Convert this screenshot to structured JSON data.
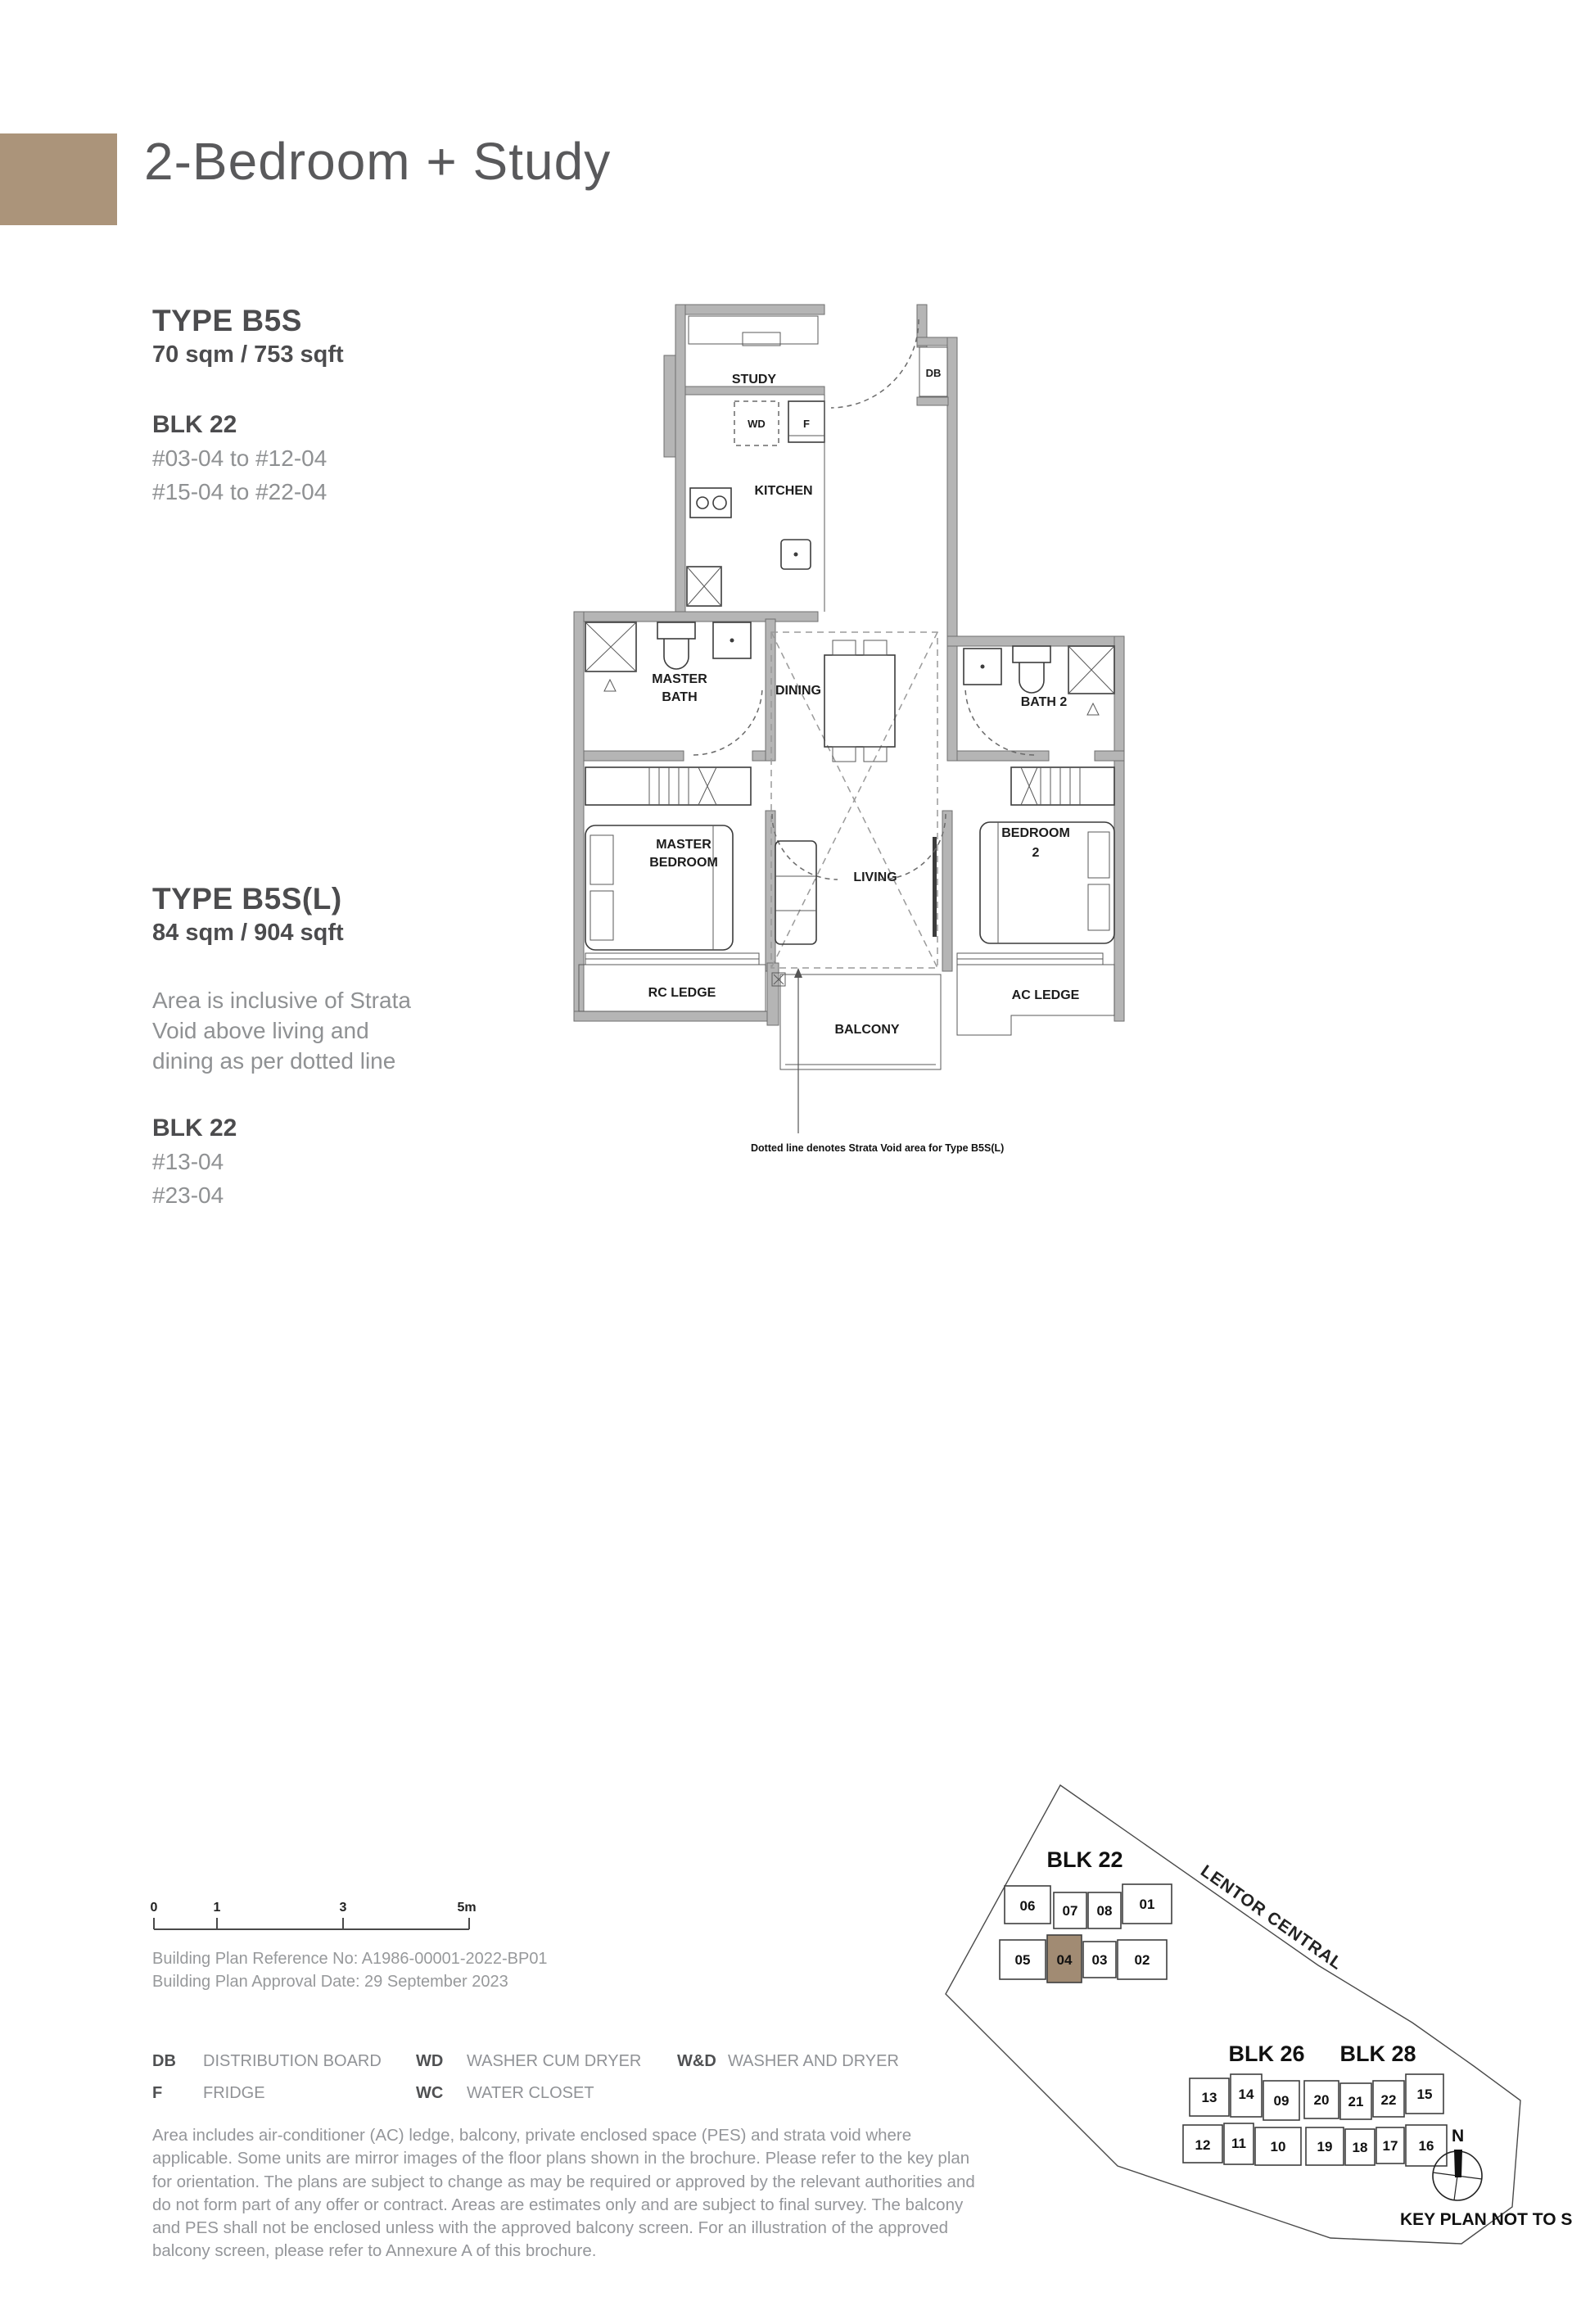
{
  "header": {
    "title": "2-Bedroom + Study",
    "accent_color": "#ab947a"
  },
  "unit_info": {
    "b5s": {
      "type": "TYPE B5S",
      "area": "70 sqm / 753 sqft",
      "block": "BLK 22",
      "floors": [
        "#03-04 to #12-04",
        "#15-04 to #22-04"
      ]
    },
    "b5sl": {
      "type": "TYPE B5S(L)",
      "area": "84 sqm / 904 sqft",
      "note": "Area is inclusive of Strata Void above living and dining as per dotted line",
      "block": "BLK 22",
      "floors": [
        "#13-04",
        "#23-04"
      ]
    }
  },
  "floor_plan": {
    "rooms": {
      "study": "STUDY",
      "kitchen": "KITCHEN",
      "dining": "DINING",
      "master_bath_1": "MASTER",
      "master_bath_2": "BATH",
      "bath2": "BATH 2",
      "master_bedroom_1": "MASTER",
      "master_bedroom_2": "BEDROOM",
      "living": "LIVING",
      "bedroom2_1": "BEDROOM",
      "bedroom2_2": "2",
      "rc_ledge": "RC LEDGE",
      "balcony": "BALCONY",
      "ac_ledge": "AC LEDGE"
    },
    "markers": {
      "db": "DB",
      "wd": "WD",
      "fridge": "F"
    },
    "strata_note": "Dotted line denotes Strata Void area for Type B5S(L)"
  },
  "scale_bar": {
    "ticks": [
      "0",
      "1",
      "3",
      "5m"
    ]
  },
  "building_plan": {
    "reference": "Building Plan Reference No: A1986-00001-2022-BP01",
    "approval": "Building Plan Approval Date: 29 September 2023"
  },
  "legend": {
    "col1": [
      {
        "k": "DB",
        "v": "DISTRIBUTION BOARD"
      },
      {
        "k": "F",
        "v": "FRIDGE"
      }
    ],
    "col2": [
      {
        "k": "WD",
        "v": "WASHER CUM DRYER"
      },
      {
        "k": "WC",
        "v": "WATER CLOSET"
      }
    ],
    "col3": [
      {
        "k": "W&D",
        "v": "WASHER AND DRYER"
      }
    ]
  },
  "disclaimer": "Area includes air-conditioner (AC) ledge, balcony, private enclosed space (PES) and strata void where applicable. Some units are mirror images of the floor plans shown in the brochure. Please refer to the key plan for orientation. The plans are subject to change as may be required or approved by the relevant authorities and do not form part of any offer or contract. Areas are estimates only and are subject to final survey. The balcony and PES shall not be enclosed unless with the approved balcony screen. For an illustration of the approved balcony screen, please refer to Annexure A of this brochure.",
  "key_plan": {
    "road": "LENTOR CENTRAL",
    "blk22_title": "BLK 22",
    "blk26_title": "BLK 26",
    "blk28_title": "BLK 28",
    "north": "N",
    "caption": "KEY PLAN NOT TO SCALE",
    "highlight_color": "#a18b73",
    "highlighted_unit": "04",
    "blk22_top": [
      "06",
      "07",
      "08",
      "01"
    ],
    "blk22_bottom": [
      "05",
      "04",
      "03",
      "02"
    ],
    "blk26_top": [
      "13",
      "14",
      "09"
    ],
    "blk26_bottom": [
      "12",
      "11",
      "10"
    ],
    "blk28_top": [
      "20",
      "21",
      "22",
      "15"
    ],
    "blk28_bottom": [
      "19",
      "18",
      "17",
      "16"
    ]
  }
}
